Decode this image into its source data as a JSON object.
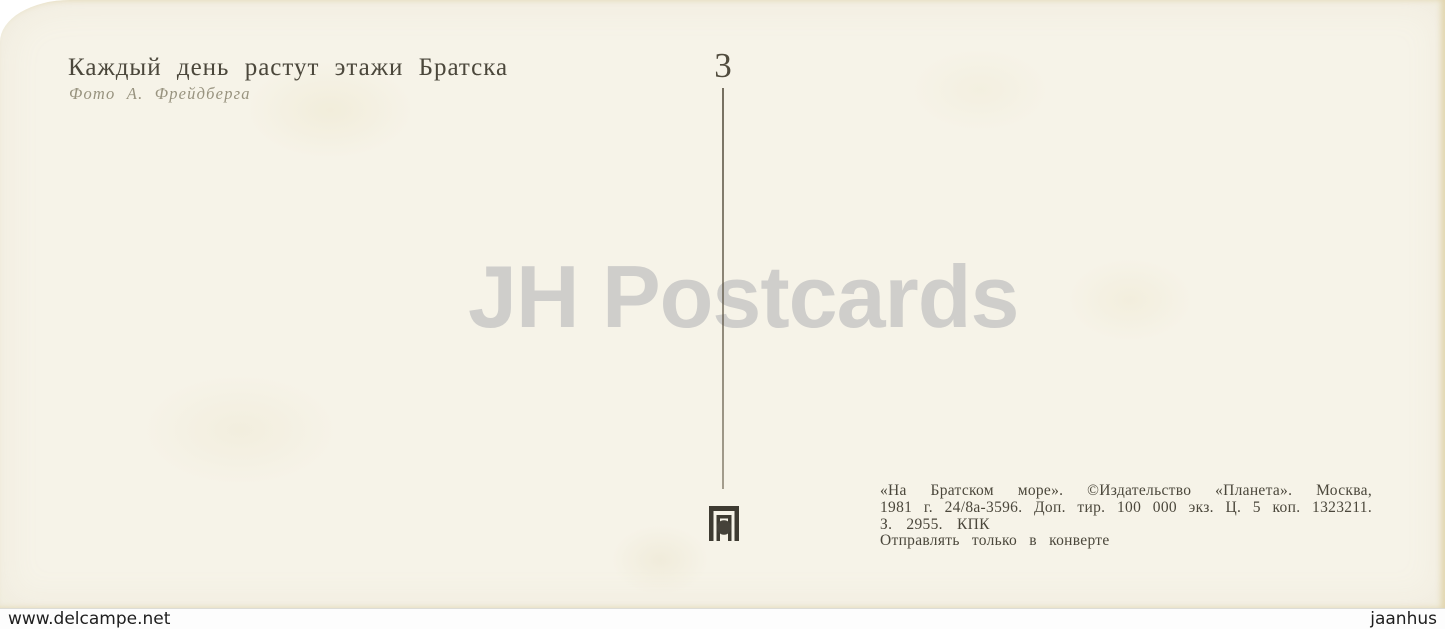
{
  "postcard": {
    "caption": {
      "title": "Каждый день растут этажи Братска",
      "photo_credit": "Фото А. Фрейдберга"
    },
    "series_number": "3",
    "publisher": {
      "logo_icon": "planeta-publisher-logo",
      "lines": [
        "«На Братском море». ©Издательство «Планета». Москва,",
        "1981 г. 24/8а-3596. Доп. тир. 100 000 экз. Ц. 5 коп. 1323211.",
        "З. 2955. КПК",
        "Отправлять только в конверте"
      ]
    }
  },
  "watermarks": {
    "center": "JH Postcards",
    "bottom_left": "www.delcampe.net",
    "bottom_right": "jaanhus"
  },
  "colors": {
    "card_background": "#f6f3e8",
    "ink": "#4b473b",
    "ink_light": "#98937f",
    "logo_ink": "#3e3b32",
    "center_watermark": "#cfcecb",
    "footer_background": "#fdfdfd",
    "footer_text": "#1e1e1e"
  }
}
